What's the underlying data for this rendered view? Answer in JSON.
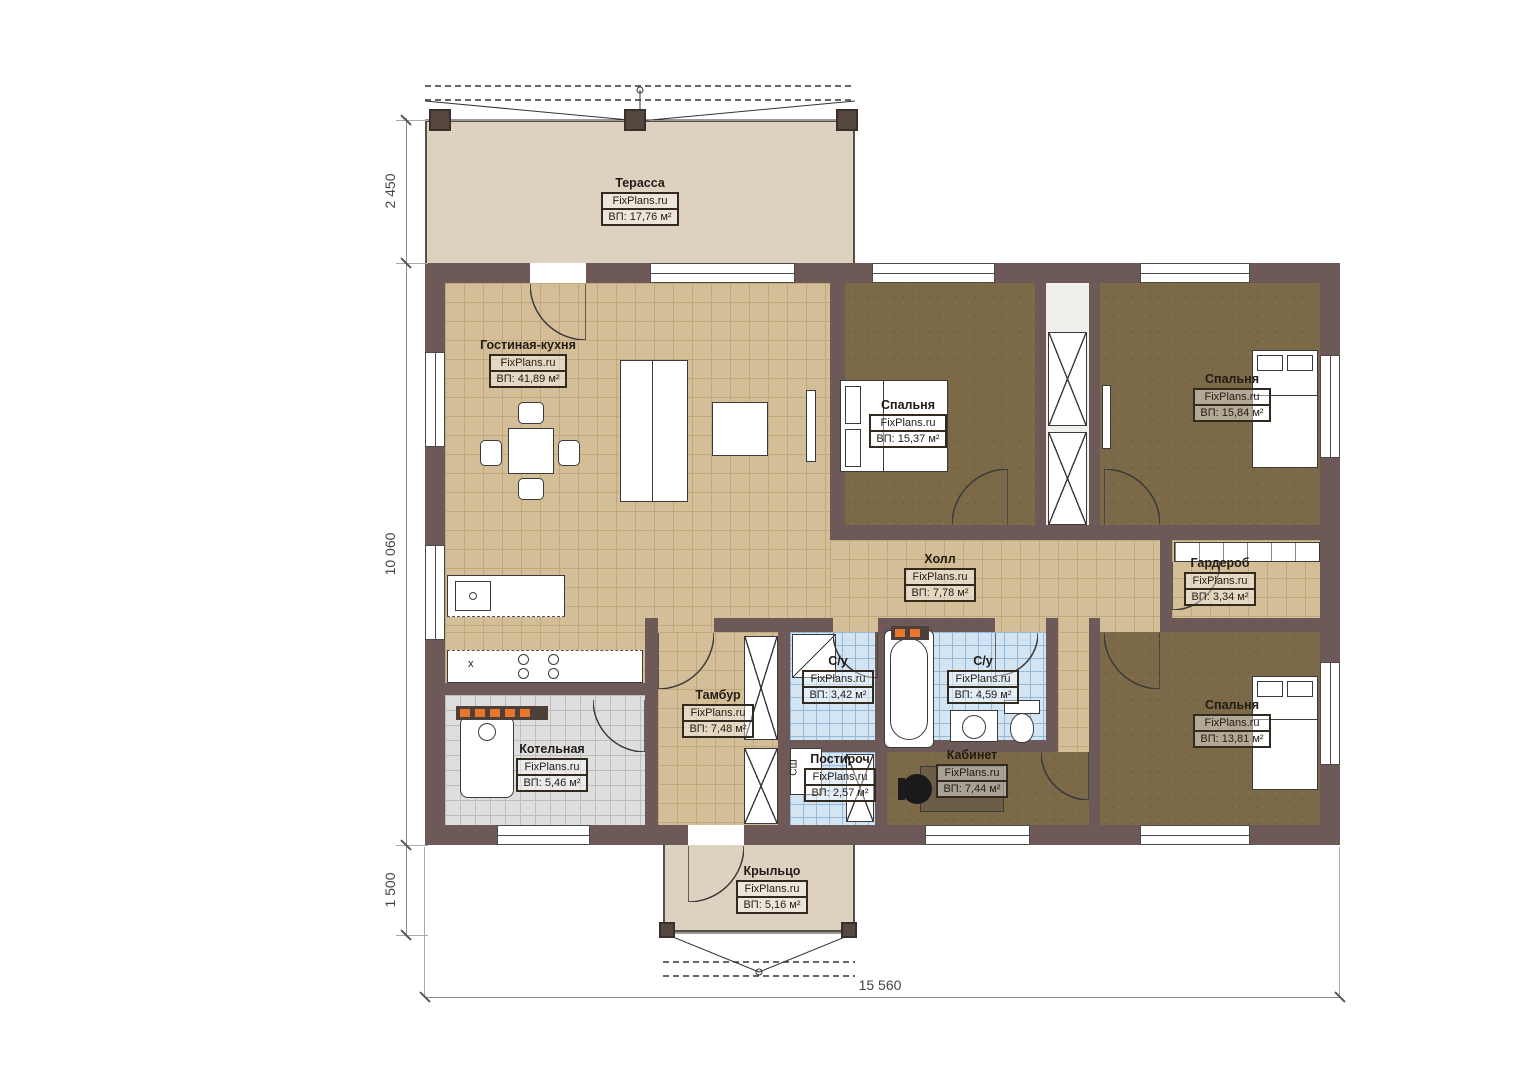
{
  "brand": "FixPlans.ru",
  "rooms": [
    {
      "name": "Терасса",
      "area": "ВП: 17,76 м²"
    },
    {
      "name": "Гостиная-кухня",
      "area": "ВП: 41,89 м²"
    },
    {
      "name": "Спальня",
      "area": "ВП: 15,37 м²"
    },
    {
      "name": "Спальня",
      "area": "ВП: 15,84 м²"
    },
    {
      "name": "Холл",
      "area": "ВП: 7,78 м²"
    },
    {
      "name": "Гардероб",
      "area": "ВП: 3,34 м²"
    },
    {
      "name": "Тамбур",
      "area": "ВП: 7,48 м²"
    },
    {
      "name": "С/у",
      "area": "ВП: 3,42 м²"
    },
    {
      "name": "С/у",
      "area": "ВП: 4,59 м²"
    },
    {
      "name": "Котельная",
      "area": "ВП: 5,46 м²"
    },
    {
      "name": "Постироч",
      "area": "ВП: 2,57 м²"
    },
    {
      "name": "Кабинет",
      "area": "ВП: 7,44 м²"
    },
    {
      "name": "Спальня",
      "area": "ВП: 13,81 м²"
    },
    {
      "name": "Крыльцо",
      "area": "ВП: 5,16 м²"
    }
  ],
  "dimensions": {
    "terrace_depth": "2 450",
    "house_height": "10 060",
    "porch_depth": "1 500",
    "house_width": "15 560"
  },
  "marks": {
    "washing_machine": "СШ",
    "sink": "x"
  }
}
